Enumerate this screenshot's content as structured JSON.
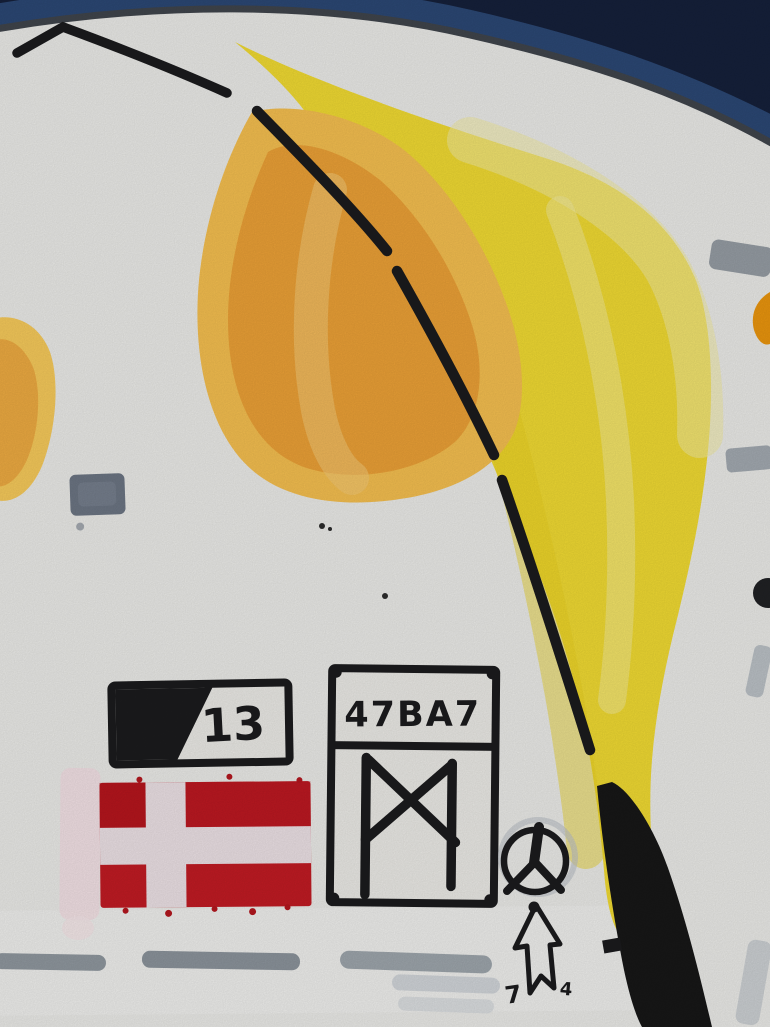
{
  "art": {
    "labels": {
      "plate_number": "13",
      "code": "47BA7",
      "arrow_mark_left": "7",
      "arrow_mark_right": "4"
    },
    "symbols": [
      {
        "name": "danish-flag"
      },
      {
        "name": "mannaz-rune",
        "glyph": "ᛗ"
      },
      {
        "name": "death-rune-circle",
        "glyph": "ᛦ"
      },
      {
        "name": "up-arrow",
        "glyph": "⇧"
      },
      {
        "name": "plate-number-box"
      },
      {
        "name": "code-box"
      },
      {
        "name": "dashed-stem-line"
      }
    ],
    "colors": {
      "background_navy": "#15203a",
      "rim_blue": "#2d4b7a",
      "panel_edge": "#3f444b",
      "paper": "#e9e9e6",
      "petal_yellow": "#eed832",
      "petal_yellow_pale": "#f0e9a0",
      "petal_orange": "#e99f36",
      "petal_orange_light": "#f2bd4f",
      "flag_red": "#bf1b23",
      "flag_cross": "#eadfe3",
      "pink_stripe": "#f1dee2",
      "ink": "#1b1b1d",
      "gray_mark": "#8e969d",
      "gray_square": "#6b7482"
    }
  }
}
